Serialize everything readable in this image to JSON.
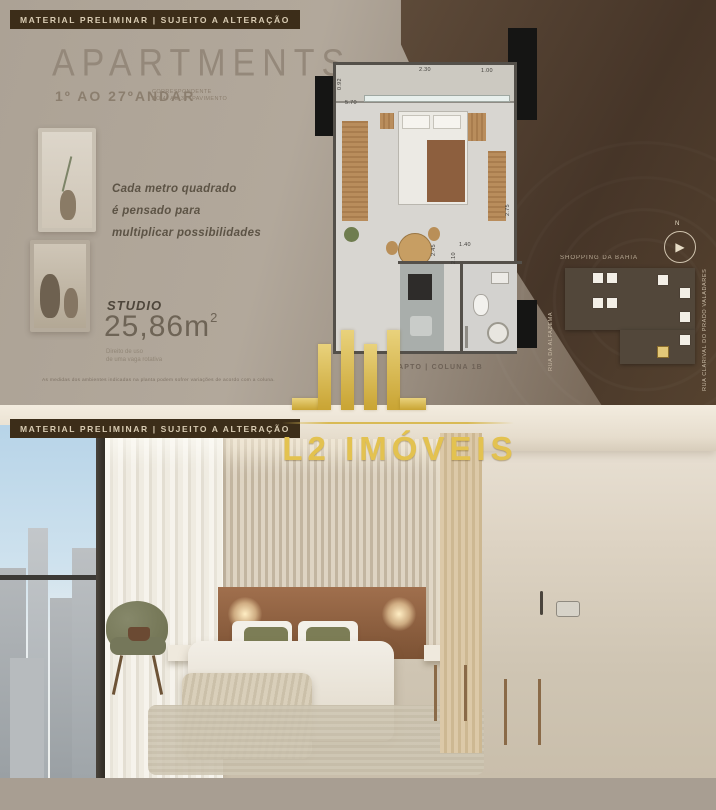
{
  "badge": {
    "text": "MATERIAL PRELIMINAR |  SUJEITO A ALTERAÇÃO"
  },
  "top": {
    "title": "APARTMENTS",
    "floors": "1º AO 27ºANDAR",
    "floors_note": {
      "line1": "CORRESPONDENTE",
      "line2": "AO 4º AO 30º PAVIMENTO"
    },
    "tagline": {
      "line1": "Cada metro quadrado",
      "line2": "é pensado para",
      "line3": "multiplicar possibilidades"
    },
    "unit_type": "STUDIO",
    "area": "25,86m",
    "area_sup": "2",
    "parking_note": {
      "line1": "Direito de uso",
      "line2": "de uma vaga rotativa"
    },
    "disclaimer": "As medidas dos ambientes indicadas na planta podem sofrer variações de acordo com a coluna.",
    "plan": {
      "label": "APTO | COLUNA 1B",
      "dims": {
        "balcony_a": "2.30",
        "balcony_b": "1.00",
        "width": "5.70",
        "left_v": "0.92",
        "right_v": "2.75",
        "kitchen_v": "2.45",
        "bath_v": "2.10",
        "hall": "1.40"
      }
    },
    "map": {
      "poi": "SHOPPING DA BAHIA",
      "street_left": "RUA DA ALFAZEMA",
      "street_right": "RUA CLARIVAL DO PRADO VALADARES",
      "compass": "N"
    }
  },
  "logo": {
    "text": "L2 IMÓVEIS"
  },
  "footer": {
    "left": "APARTMENTS",
    "right": "STUDIO 25,86m",
    "right_sup": "2"
  },
  "colors": {
    "gold": "#e3c250",
    "badge_bg": "#3c2d19",
    "dark_brown": "#4a382c",
    "taupe": "#a89e92"
  }
}
